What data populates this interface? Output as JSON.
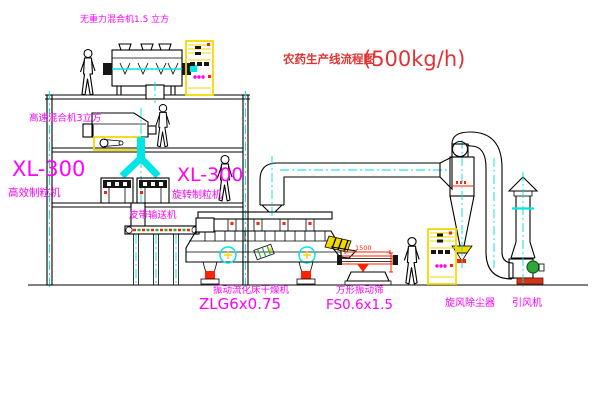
{
  "title": {
    "text": "农药生产线流程图",
    "capacity": "(500kg/h)"
  },
  "labels": {
    "gravity_mixer": "无重力混合机1.5 立方",
    "high_speed_mixer": "高速混合机3立方",
    "granulator_left_model": "XL-300",
    "granulator_left_name": "高效制粒机",
    "granulator_right_model": "XL-300",
    "granulator_right_name": "旋转制粒机",
    "belt_conveyor": "皮带输送机",
    "fluid_bed_dryer_name": "振动流化床干燥机",
    "fluid_bed_dryer_model": "ZLG6x0.75",
    "vibrating_sieve_name": "方形振动筛",
    "vibrating_sieve_model": "FS0.6x1.5",
    "cyclone_dust_collector": "旋风除尘器",
    "induced_draft_fan": "引风机"
  },
  "dimensions": {
    "sieve_length": "1500"
  },
  "colors": {
    "line": "#000000",
    "label_magenta": "#ff00ff",
    "title_red": "#e03434",
    "centerline_cyan": "#00dede",
    "equipment_yellow": "#f0da00",
    "accent_red": "#ff2200",
    "accent_green": "#2fa63c",
    "pipe_cyan": "#00e5e5"
  }
}
